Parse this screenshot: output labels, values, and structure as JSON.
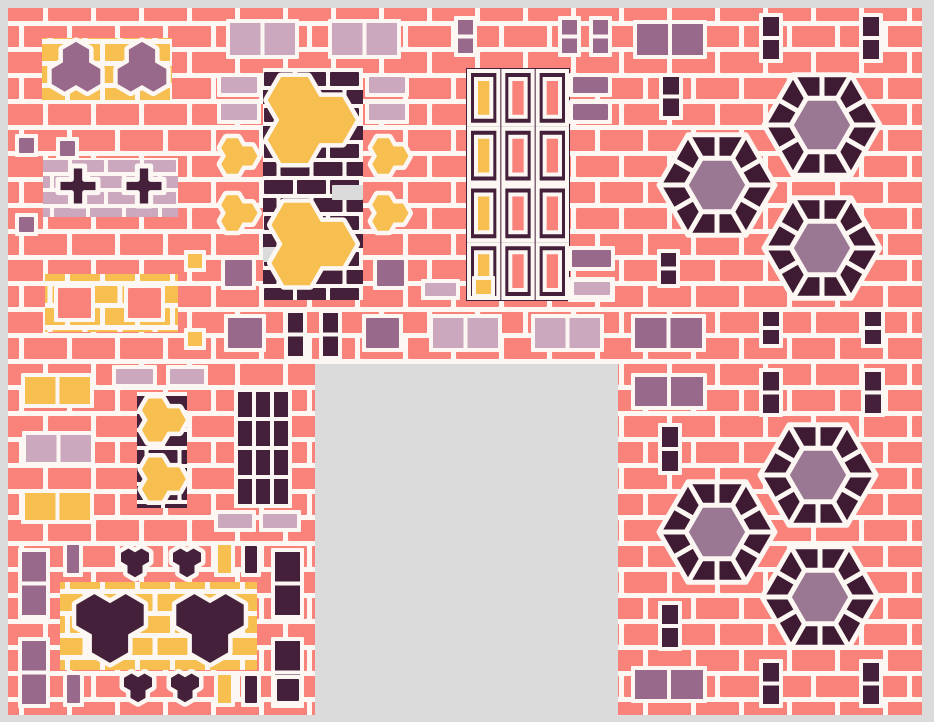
{
  "canvas": {
    "width": 934,
    "height": 722,
    "background": "#DBDBDB",
    "mortar": "#FCF7F3"
  },
  "palette": {
    "salmon": "#F9827A",
    "yellow": "#F7BF4F",
    "mauve": "#99698C",
    "mauve_light": "#CCA8BE",
    "dark": "#44203A",
    "hex_ring": "#3E1B32",
    "hex_center": "#9A7793",
    "gray": "#DBDBDB"
  },
  "bricks": {
    "salmon": {
      "w": 43,
      "h": 21,
      "gap": 5
    },
    "dark": {
      "w": 29,
      "h": 14,
      "gap": 4
    },
    "yellow": {
      "w": 30,
      "h": 17,
      "gap": 5
    },
    "mauve_light": {
      "w": 32,
      "h": 12,
      "gap": 4
    }
  },
  "base": {
    "x": 8,
    "y": 8,
    "w": 914,
    "h": 707,
    "pal": "salmon"
  },
  "hole": {
    "x": 315,
    "y": 364,
    "w": 303,
    "h": 351
  },
  "hexflower": {
    "outer_r": 58,
    "inner_r": 31,
    "ring": "hex_ring",
    "center": "hex_center"
  },
  "shapes": [
    {
      "type": "brick",
      "pal": "yellow",
      "x": 42,
      "y": 38,
      "w": 130,
      "h": 62
    },
    {
      "type": "trefoil",
      "fill": "mauve",
      "cx": 76,
      "cy": 70,
      "s": 26,
      "rot": -90
    },
    {
      "type": "trefoil",
      "fill": "mauve",
      "cx": 142,
      "cy": 70,
      "s": 26,
      "rot": -90
    },
    {
      "type": "brick",
      "pal": "mauve_light",
      "x": 43,
      "y": 158,
      "w": 135,
      "h": 59
    },
    {
      "type": "cross",
      "fill": "dark",
      "cx": 78,
      "cy": 186,
      "s": 40
    },
    {
      "type": "cross",
      "fill": "dark",
      "cx": 144,
      "cy": 186,
      "s": 40
    },
    {
      "type": "brick",
      "pal": "yellow",
      "x": 45,
      "y": 274,
      "w": 133,
      "h": 58
    },
    {
      "type": "rect",
      "fill": "salmon",
      "frame": true,
      "x": 58,
      "y": 288,
      "w": 33,
      "h": 30
    },
    {
      "type": "rect",
      "fill": "salmon",
      "frame": true,
      "x": 128,
      "y": 288,
      "w": 33,
      "h": 30
    },
    {
      "type": "rect",
      "fill": "mauve",
      "frame": true,
      "x": 19,
      "y": 138,
      "w": 15,
      "h": 15
    },
    {
      "type": "rect",
      "fill": "mauve",
      "frame": true,
      "x": 60,
      "y": 141,
      "w": 15,
      "h": 15
    },
    {
      "type": "rect",
      "fill": "mauve",
      "frame": true,
      "x": 19,
      "y": 217,
      "w": 15,
      "h": 15
    },
    {
      "type": "rect",
      "fill": "yellow",
      "frame": true,
      "x": 188,
      "y": 254,
      "w": 14,
      "h": 14
    },
    {
      "type": "rect",
      "fill": "yellow",
      "frame": true,
      "x": 188,
      "y": 332,
      "w": 14,
      "h": 14
    },
    {
      "type": "pair",
      "fill": "yellow",
      "x": 25,
      "y": 377,
      "w": 65,
      "h": 27
    },
    {
      "type": "pair",
      "fill": "mauve_light",
      "x": 26,
      "y": 435,
      "w": 65,
      "h": 27
    },
    {
      "type": "pair",
      "fill": "yellow",
      "x": 25,
      "y": 493,
      "w": 65,
      "h": 27
    },
    {
      "type": "rect",
      "fill": "mauve_light",
      "frame": true,
      "x": 116,
      "y": 369,
      "w": 37,
      "h": 15
    },
    {
      "type": "rect",
      "fill": "mauve_light",
      "frame": true,
      "x": 170,
      "y": 369,
      "w": 34,
      "h": 15
    },
    {
      "type": "brick",
      "pal": "dark",
      "x": 137,
      "y": 392,
      "w": 50,
      "h": 116
    },
    {
      "type": "trefoil",
      "fill": "yellow",
      "cx": 161,
      "cy": 420,
      "s": 23,
      "rot": 0
    },
    {
      "type": "trefoil",
      "fill": "yellow",
      "cx": 161,
      "cy": 479,
      "s": 23,
      "rot": 0
    },
    {
      "type": "bargrid",
      "fill": "dark",
      "x": 238,
      "y": 392,
      "cols": 3,
      "rows": 4,
      "bw": 14,
      "bh": 25,
      "gx": 4,
      "gy": 4
    },
    {
      "type": "rect",
      "fill": "mauve_light",
      "frame": true,
      "x": 218,
      "y": 514,
      "w": 34,
      "h": 14
    },
    {
      "type": "rect",
      "fill": "mauve_light",
      "frame": true,
      "x": 263,
      "y": 514,
      "w": 34,
      "h": 14
    },
    {
      "type": "pair",
      "fill": "mauve",
      "vertical": true,
      "x": 22,
      "y": 552,
      "w": 24,
      "h": 63
    },
    {
      "type": "pair",
      "fill": "mauve",
      "vertical": true,
      "x": 22,
      "y": 641,
      "w": 24,
      "h": 63
    },
    {
      "type": "brick",
      "pal": "yellow",
      "x": 60,
      "y": 582,
      "w": 197,
      "h": 88
    },
    {
      "type": "trefoil",
      "fill": "dark",
      "cx": 110,
      "cy": 624,
      "s": 36,
      "rot": 90
    },
    {
      "type": "trefoil",
      "fill": "dark",
      "cx": 210,
      "cy": 624,
      "s": 36,
      "rot": 90
    },
    {
      "type": "trefoil",
      "fill": "dark",
      "cx": 135,
      "cy": 561,
      "s": 15,
      "rot": 90
    },
    {
      "type": "trefoil",
      "fill": "dark",
      "cx": 187,
      "cy": 561,
      "s": 15,
      "rot": 90
    },
    {
      "type": "trefoil",
      "fill": "dark",
      "cx": 138,
      "cy": 686,
      "s": 15,
      "rot": 90
    },
    {
      "type": "trefoil",
      "fill": "dark",
      "cx": 185,
      "cy": 686,
      "s": 15,
      "rot": 90
    },
    {
      "type": "pair",
      "fill": "dark",
      "vertical": true,
      "x": 275,
      "y": 552,
      "w": 25,
      "h": 63
    },
    {
      "type": "pair",
      "fill": "dark",
      "vertical": true,
      "x": 275,
      "y": 641,
      "w": 25,
      "h": 63
    },
    {
      "type": "rect",
      "fill": "mauve",
      "frame": true,
      "x": 67,
      "y": 545,
      "w": 12,
      "h": 28
    },
    {
      "type": "rect",
      "fill": "mauve",
      "frame": true,
      "x": 67,
      "y": 675,
      "w": 13,
      "h": 28
    },
    {
      "type": "rect",
      "fill": "yellow",
      "frame": true,
      "x": 218,
      "y": 545,
      "w": 13,
      "h": 28
    },
    {
      "type": "rect",
      "fill": "yellow",
      "frame": true,
      "x": 218,
      "y": 675,
      "w": 13,
      "h": 28
    },
    {
      "type": "rect",
      "fill": "dark",
      "frame": true,
      "x": 245,
      "y": 546,
      "w": 12,
      "h": 27
    },
    {
      "type": "rect",
      "fill": "dark",
      "frame": true,
      "x": 245,
      "y": 676,
      "w": 12,
      "h": 27
    },
    {
      "type": "rect",
      "fill": "dark",
      "frame": true,
      "x": 277,
      "y": 679,
      "w": 22,
      "h": 22
    },
    {
      "type": "pair",
      "fill": "mauve_light",
      "x": 230,
      "y": 23,
      "w": 65,
      "h": 32
    },
    {
      "type": "pair",
      "fill": "mauve_light",
      "x": 332,
      "y": 23,
      "w": 65,
      "h": 32
    },
    {
      "type": "brick",
      "pal": "dark",
      "x": 263,
      "y": 68,
      "w": 100,
      "h": 232
    },
    {
      "type": "rect",
      "fill": "gray",
      "x": 332,
      "y": 185,
      "w": 31,
      "h": 15
    },
    {
      "type": "rect",
      "fill": "gray",
      "x": 263,
      "y": 247,
      "w": 16,
      "h": 15
    },
    {
      "type": "trefoil",
      "fill": "yellow",
      "cx": 306,
      "cy": 120,
      "s": 46,
      "rot": 0
    },
    {
      "type": "trefoil",
      "fill": "yellow",
      "cx": 308,
      "cy": 244,
      "s": 44,
      "rot": 0
    },
    {
      "type": "trefoil",
      "fill": "yellow",
      "cx": 237,
      "cy": 156,
      "s": 19,
      "rot": 0
    },
    {
      "type": "trefoil",
      "fill": "yellow",
      "cx": 237,
      "cy": 213,
      "s": 19,
      "rot": 0
    },
    {
      "type": "trefoil",
      "fill": "yellow",
      "cx": 388,
      "cy": 156,
      "s": 19,
      "rot": 0
    },
    {
      "type": "trefoil",
      "fill": "yellow",
      "cx": 388,
      "cy": 213,
      "s": 19,
      "rot": 0
    },
    {
      "type": "rect",
      "fill": "mauve_light",
      "frame": true,
      "x": 221,
      "y": 77,
      "w": 36,
      "h": 16
    },
    {
      "type": "rect",
      "fill": "mauve_light",
      "frame": true,
      "x": 221,
      "y": 104,
      "w": 36,
      "h": 16
    },
    {
      "type": "rect",
      "fill": "mauve_light",
      "frame": true,
      "x": 369,
      "y": 77,
      "w": 36,
      "h": 16
    },
    {
      "type": "rect",
      "fill": "mauve_light",
      "frame": true,
      "x": 369,
      "y": 104,
      "w": 36,
      "h": 16
    },
    {
      "type": "rect",
      "fill": "mauve",
      "frame": true,
      "x": 225,
      "y": 260,
      "w": 27,
      "h": 26
    },
    {
      "type": "rect",
      "fill": "mauve",
      "frame": true,
      "x": 377,
      "y": 260,
      "w": 27,
      "h": 26
    },
    {
      "type": "framegrid",
      "x": 466,
      "y": 68,
      "w": 104,
      "h": 233,
      "cols": 3,
      "rows": 4,
      "col_fills": [
        "yellow",
        "salmon",
        "salmon"
      ]
    },
    {
      "type": "pair",
      "fill": "mauve",
      "vertical": true,
      "x": 458,
      "y": 20,
      "w": 15,
      "h": 33
    },
    {
      "type": "pair",
      "fill": "mauve",
      "vertical": true,
      "x": 562,
      "y": 20,
      "w": 15,
      "h": 33
    },
    {
      "type": "pair",
      "fill": "mauve",
      "vertical": true,
      "x": 593,
      "y": 20,
      "w": 15,
      "h": 33
    },
    {
      "type": "pair",
      "fill": "mauve",
      "x": 637,
      "y": 24,
      "w": 66,
      "h": 31
    },
    {
      "type": "rect",
      "fill": "mauve",
      "frame": true,
      "x": 573,
      "y": 77,
      "w": 35,
      "h": 16
    },
    {
      "type": "rect",
      "fill": "mauve",
      "frame": true,
      "x": 573,
      "y": 104,
      "w": 35,
      "h": 16
    },
    {
      "type": "pair",
      "fill": "dark",
      "vertical": true,
      "x": 663,
      "y": 77,
      "w": 16,
      "h": 39
    },
    {
      "type": "pair",
      "fill": "dark",
      "vertical": true,
      "x": 763,
      "y": 17,
      "w": 16,
      "h": 42
    },
    {
      "type": "pair",
      "fill": "dark",
      "vertical": true,
      "x": 863,
      "y": 17,
      "w": 16,
      "h": 42
    },
    {
      "type": "hexflower",
      "cx": 822,
      "cy": 125
    },
    {
      "type": "hexflower",
      "cx": 717,
      "cy": 185
    },
    {
      "type": "hexflower",
      "cx": 822,
      "cy": 248
    },
    {
      "type": "pair",
      "fill": "dark",
      "vertical": true,
      "x": 661,
      "y": 253,
      "w": 15,
      "h": 31
    },
    {
      "type": "rect",
      "fill": "mauve",
      "frame": true,
      "x": 572,
      "y": 250,
      "w": 39,
      "h": 17
    },
    {
      "type": "rect",
      "fill": "mauve",
      "frame": true,
      "x": 572,
      "y": 281,
      "w": 39,
      "h": 17
    },
    {
      "type": "pair",
      "fill": "dark",
      "vertical": true,
      "x": 763,
      "y": 312,
      "w": 16,
      "h": 32
    },
    {
      "type": "pair",
      "fill": "dark",
      "vertical": true,
      "x": 865,
      "y": 312,
      "w": 16,
      "h": 32
    },
    {
      "type": "pair",
      "fill": "mauve",
      "x": 635,
      "y": 318,
      "w": 67,
      "h": 30
    },
    {
      "type": "rect",
      "fill": "mauve",
      "frame": true,
      "x": 228,
      "y": 318,
      "w": 34,
      "h": 30
    },
    {
      "type": "pair",
      "fill": "dark",
      "vertical": true,
      "x": 288,
      "y": 313,
      "w": 15,
      "h": 43
    },
    {
      "type": "pair",
      "fill": "dark",
      "vertical": true,
      "x": 323,
      "y": 313,
      "w": 15,
      "h": 43
    },
    {
      "type": "rect",
      "fill": "mauve",
      "frame": true,
      "x": 366,
      "y": 318,
      "w": 33,
      "h": 30
    },
    {
      "type": "pair",
      "fill": "mauve_light",
      "x": 433,
      "y": 318,
      "w": 65,
      "h": 30
    },
    {
      "type": "pair",
      "fill": "mauve_light",
      "x": 535,
      "y": 318,
      "w": 65,
      "h": 30
    },
    {
      "type": "rect",
      "fill": "mauve_light",
      "frame": true,
      "x": 425,
      "y": 283,
      "w": 31,
      "h": 13
    },
    {
      "type": "rect",
      "fill": "mauve_light",
      "frame": true,
      "x": 574,
      "y": 282,
      "w": 36,
      "h": 13
    },
    {
      "type": "rect",
      "fill": "yellow",
      "frame": true,
      "x": 476,
      "y": 280,
      "w": 15,
      "h": 14
    },
    {
      "type": "pair",
      "fill": "mauve",
      "x": 635,
      "y": 377,
      "w": 68,
      "h": 29
    },
    {
      "type": "pair",
      "fill": "dark",
      "vertical": true,
      "x": 763,
      "y": 372,
      "w": 16,
      "h": 41
    },
    {
      "type": "pair",
      "fill": "dark",
      "vertical": true,
      "x": 865,
      "y": 372,
      "w": 16,
      "h": 41
    },
    {
      "type": "pair",
      "fill": "dark",
      "vertical": true,
      "x": 662,
      "y": 427,
      "w": 16,
      "h": 44
    },
    {
      "type": "hexflower",
      "cx": 818,
      "cy": 475
    },
    {
      "type": "hexflower",
      "cx": 717,
      "cy": 532
    },
    {
      "type": "hexflower",
      "cx": 820,
      "cy": 597
    },
    {
      "type": "pair",
      "fill": "dark",
      "vertical": true,
      "x": 662,
      "y": 605,
      "w": 16,
      "h": 42
    },
    {
      "type": "pair",
      "fill": "mauve",
      "x": 635,
      "y": 670,
      "w": 68,
      "h": 29
    },
    {
      "type": "pair",
      "fill": "dark",
      "vertical": true,
      "x": 763,
      "y": 663,
      "w": 16,
      "h": 41
    },
    {
      "type": "pair",
      "fill": "dark",
      "vertical": true,
      "x": 863,
      "y": 663,
      "w": 16,
      "h": 41
    }
  ]
}
